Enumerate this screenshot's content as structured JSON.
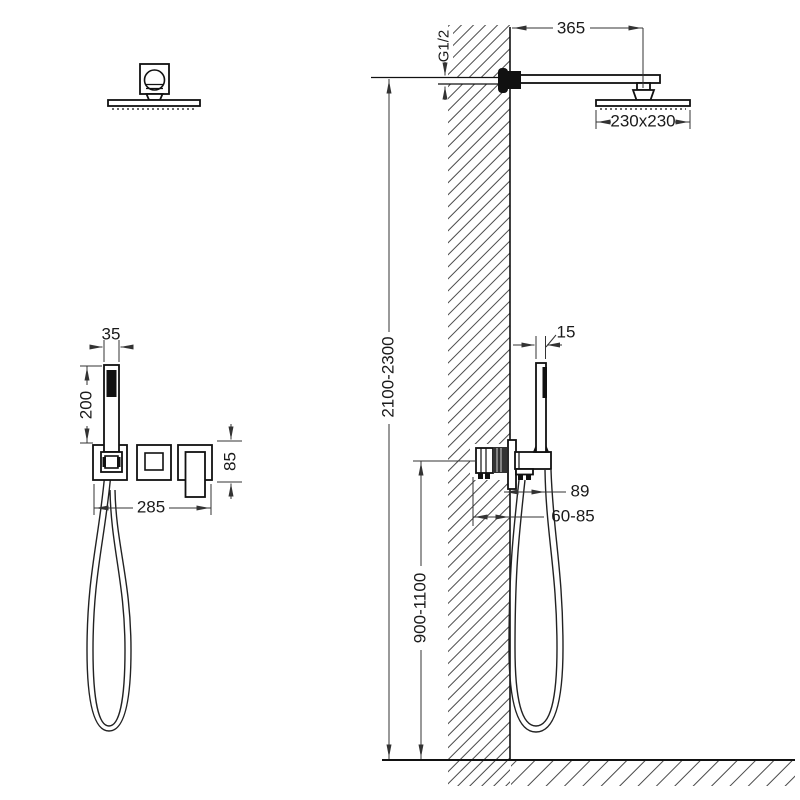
{
  "drawing": {
    "dims": {
      "arm_length": "365",
      "thread": "G1/2",
      "head_size": "230x230",
      "install_height": "2100-2300",
      "hand_width": "35",
      "hand_length": "200",
      "panel_width": "285",
      "panel_height": "85",
      "hand_thickness": "15",
      "holder_offset": "89",
      "embed_depth": "60-85",
      "valve_height": "900-1100"
    }
  }
}
